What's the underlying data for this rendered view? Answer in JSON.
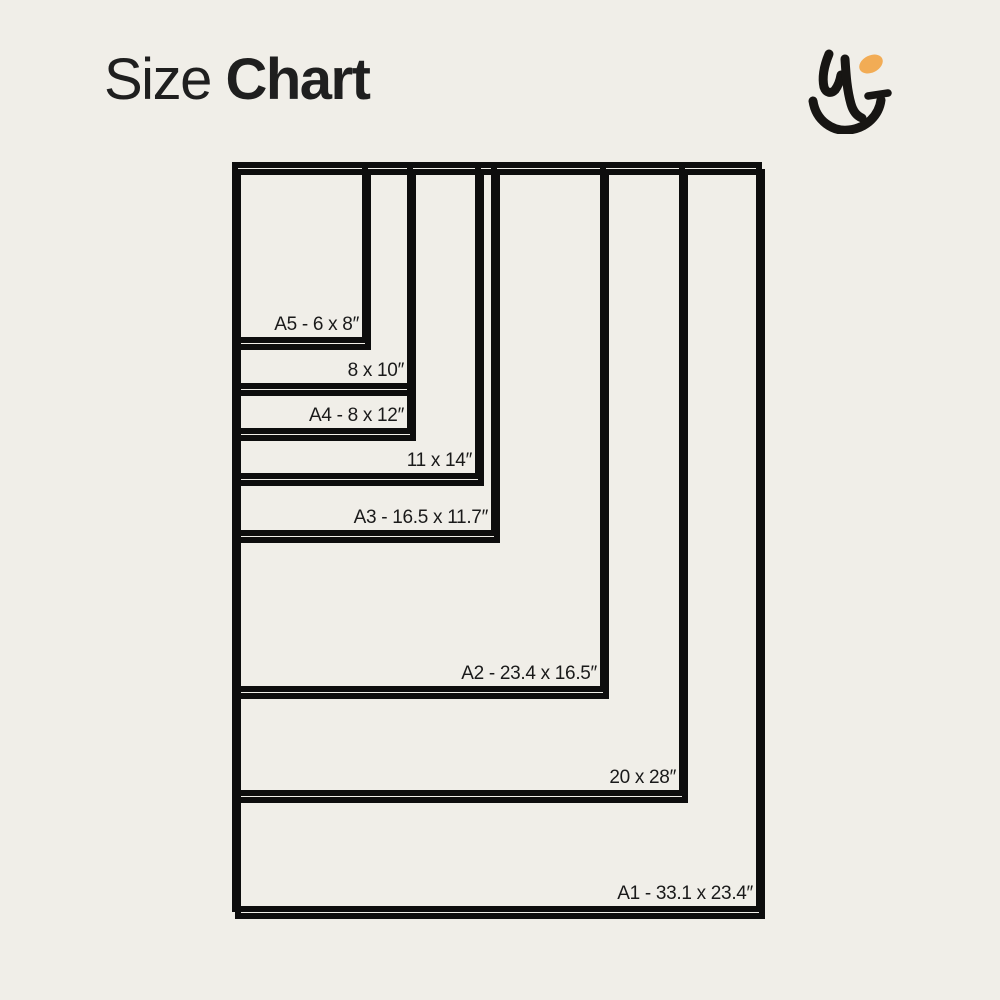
{
  "style": {
    "background": "#F0EEE8",
    "line_color": "#0D0D0D",
    "text_color": "#1A1A1A",
    "title_color": "#1F1F1F",
    "accent_orange": "#F2AC55"
  },
  "header": {
    "title_regular": "Size",
    "title_bold": "Chart"
  },
  "logo": {
    "name": "hj-monogram",
    "dot_color": "#F2AC55",
    "stroke_color": "#171513"
  },
  "chart_data": {
    "type": "table",
    "title": "Size Chart",
    "unit": "inches",
    "description_visible": "Nested print-size comparison rectangles, drawn to scale, sharing a common top-left corner",
    "sizes": [
      {
        "id": "A5",
        "label": "A5 - 6 x 8″",
        "width_in": 6,
        "height_in": 8
      },
      {
        "id": "8x10",
        "label": "8 x 10″",
        "width_in": 8,
        "height_in": 10
      },
      {
        "id": "A4",
        "label": "A4 - 8 x 12″",
        "width_in": 8,
        "height_in": 12
      },
      {
        "id": "11x14",
        "label": "11 x 14″",
        "width_in": 11,
        "height_in": 14
      },
      {
        "id": "A3",
        "label": "A3 - 16.5 x 11.7″",
        "width_in": 11.7,
        "height_in": 16.5
      },
      {
        "id": "A2",
        "label": "A2 - 23.4 x 16.5″",
        "width_in": 16.5,
        "height_in": 23.4
      },
      {
        "id": "20x28",
        "label": "20 x 28″",
        "width_in": 20,
        "height_in": 28
      },
      {
        "id": "A1",
        "label": "A1 - 33.1 x 23.4″",
        "width_in": 23.4,
        "height_in": 33.1
      }
    ]
  }
}
